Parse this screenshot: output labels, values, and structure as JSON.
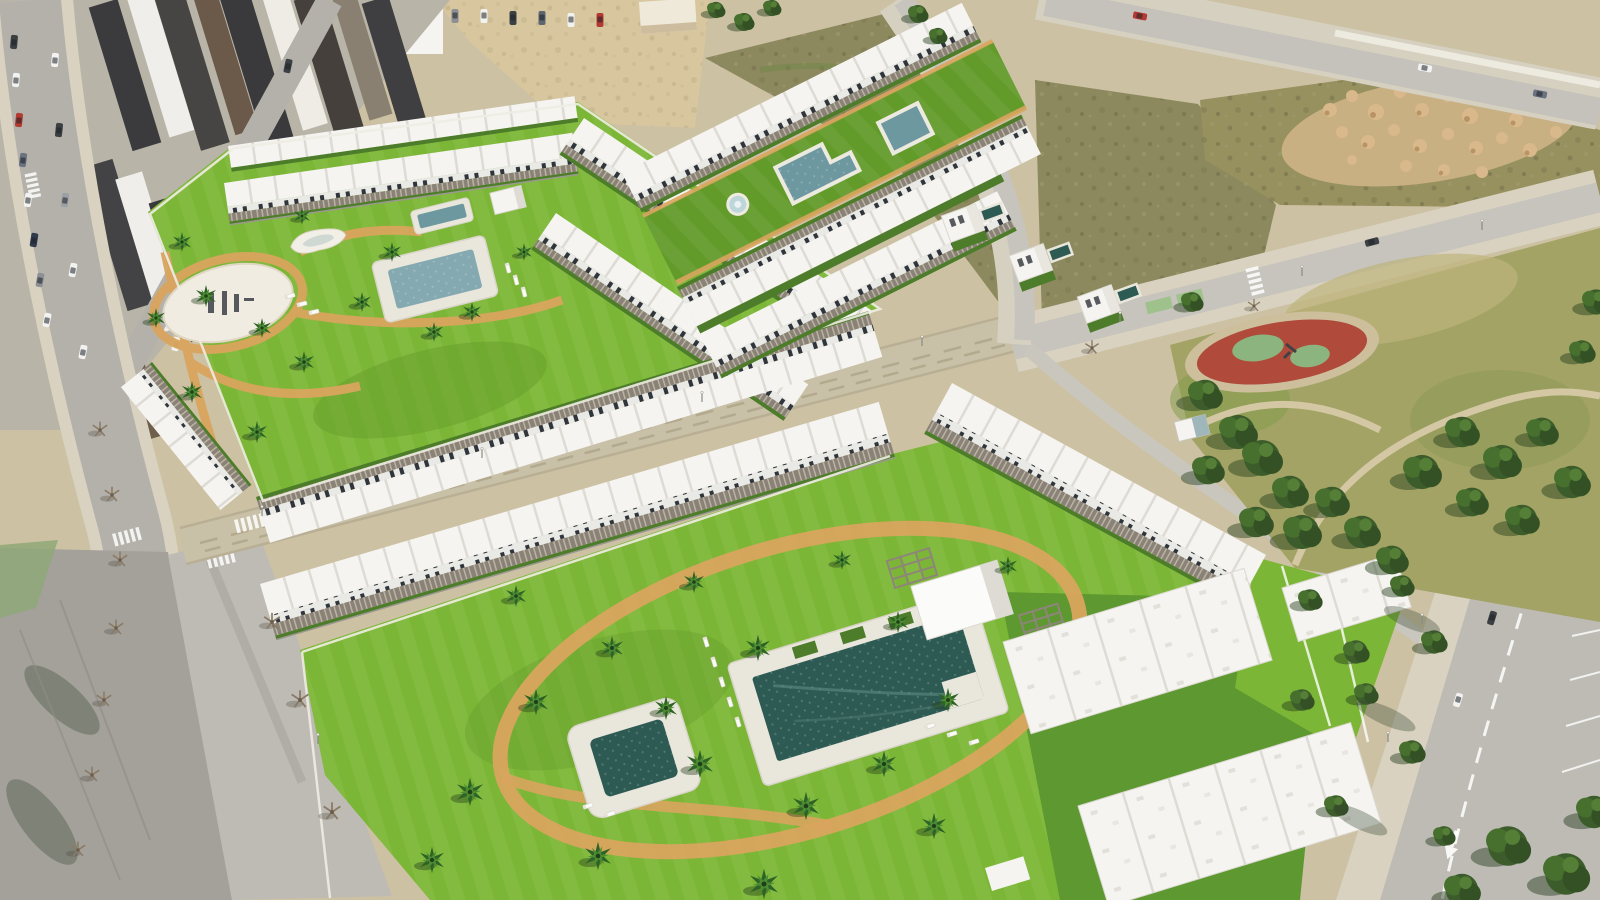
{
  "scene": {
    "title": "Aerial render of coastal residential development",
    "description": "Drone-style 3D render: new white townhouse complexes with landscaped lawns, swimming pools and palm trees, next to an existing town, vacant scrubland plots, and a public pine park with a red playground court.",
    "palette": {
      "ground_sand": "#cdc1a3",
      "sand_lot": "#d7c69e",
      "pavement_old": "#a3a19a",
      "road_gray": "#bdbbb4",
      "road_light": "#c9c6be",
      "sidewalk": "#d9d2c0",
      "dirt_road": "#c9c0a8",
      "grass_bright": "#7cb636",
      "grass_mid": "#639b2b",
      "grass_dark": "#4d7c2a",
      "lawn_gap": "#5d9830",
      "park_grass": "#a2a365",
      "park_dry": "#bdb37c",
      "scrub_olive": "#8d895e",
      "scrub_dark": "#6f6d4a",
      "mound_sand": "#d9b98b",
      "mound_shadow": "#b08a5a",
      "building_white": "#f5f4f1",
      "building_shade": "#dddbd4",
      "wall_light": "#efece3",
      "roof_charcoal": "#3b3b3d",
      "roof_brown": "#6b5a4a",
      "pergola_gray": "#8a8276",
      "pool_dark": "#2e5a54",
      "pool_mid": "#6d98a0",
      "pool_light": "#85a9b1",
      "pool_deck": "#e9e6dc",
      "path_orange": "#d9a55e",
      "playground_red": "#b04a3a",
      "playground_green": "#8cb47e",
      "marking_white": "#ffffff",
      "bike_green": "#9fc18c",
      "tree_green": "#3c5d2b",
      "tree_light": "#47702f",
      "palm_green": "#2f6326",
      "palm_light": "#4c8c33",
      "car_red": "#b33a32",
      "car_dark": "#3c4043",
      "car_white": "#f2f2f0",
      "shadow_dark": "#233c1a"
    },
    "features": {
      "town": "Existing town blocks with street parking",
      "west_complex": "Courtyard complex with pool and circular logo plaza",
      "north_complex": "Linear garden complex with fountain, lap pool and plunge pool",
      "villas": "Detached villas with private pools",
      "vacant": "Vacant scrubland plots",
      "stockpiles": "Earth stockpiles on vacant lot",
      "park": "Public park with mature pine trees",
      "playground": "Red playground court",
      "south_complex": "New townhouse complex with communal garden",
      "main_pool": "Main community swimming pool",
      "kids_pool": "Children's pool",
      "dirt_road": "Unpaved construction road",
      "avenue": "Avenue with lane markings and parking bays",
      "crossings": "Pedestrian and cycle crossings",
      "plaza": "Circular plaza with painted development logo",
      "loungers": "Sun loungers",
      "palms": "Palm trees",
      "kiosk": "Park utility kiosk"
    },
    "counts": {
      "water_features_visible": 8,
      "complexes": 3,
      "playgrounds": 1
    }
  }
}
